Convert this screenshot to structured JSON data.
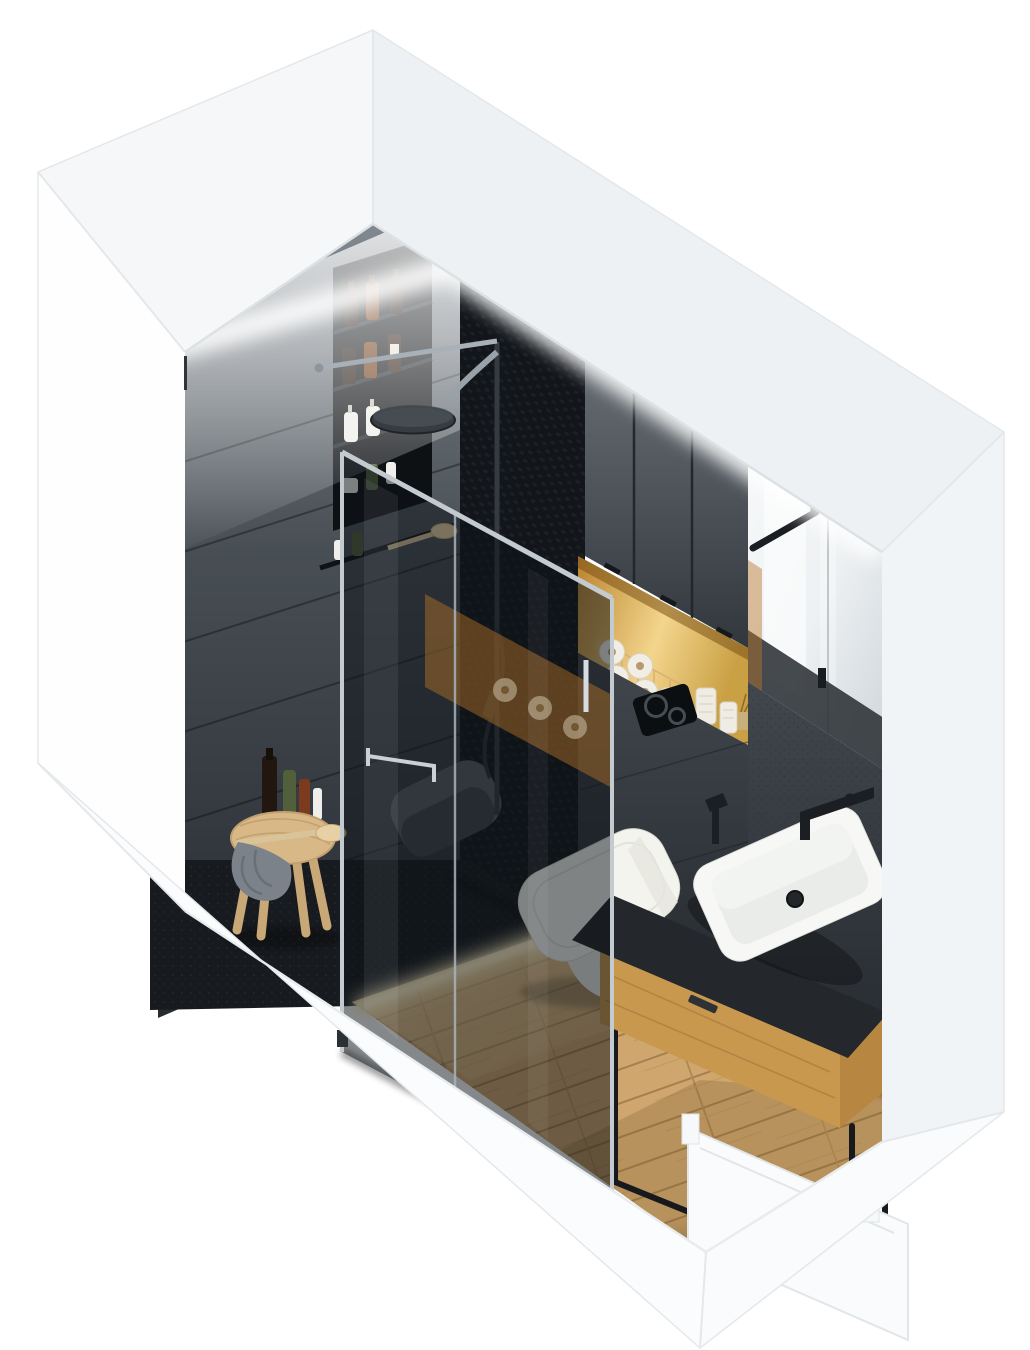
{
  "scene": {
    "kind": "isometric-bathroom-cutaway-render",
    "room": "bathroom",
    "view": "axonometric from above"
  },
  "palette": {
    "background": "#ffffff",
    "shell_white": "#fafbfc",
    "shell_top_left": "#f5f7f8",
    "shell_top_right": "#eef1f3",
    "shell_right_col": "#f1f4f6",
    "shell_left_face": "#fefeff",
    "shell_skirt": "#fbfcfd",
    "shell_edge": "#e4e8ea",
    "left_wall_top": "#8b9299",
    "left_wall_mid": "#474e54",
    "left_wall_dark": "#262b30",
    "woven_wall": "#14171b",
    "cabinet_light": "#6b7278",
    "cabinet_dark": "#31373d",
    "niche_wood": "#b9842f",
    "niche_glow": "#f3d58c",
    "mirror_light": "#eef1f3",
    "mirror_mid": "#ccd3d8",
    "mirror_reflection_dark": "#2c3135",
    "stone_mid": "#41474d",
    "stone_dark": "#24282d",
    "flush_plate_black": "#0c0f12",
    "glass_tint": "rgba(12,17,24,0.50)",
    "amber_reflection": "rgba(186,118,40,0.45)",
    "chrome": "#c3cbd1",
    "chrome_dark": "#8d969d",
    "matte_black": "#1b1e22",
    "toilet_white": "#f4f4ef",
    "toilet_shadow": "#d2d3cb",
    "basin_white": "#f7f8f5",
    "basin_inner": "#e9ece8",
    "counter_black": "#24272b",
    "vanity_wood_front": "#c9984f",
    "vanity_wood_side": "#b78742",
    "frame_black": "#17191d",
    "floor_wood_light": "#e8cd9b",
    "floor_wood_mid": "#cfa76e",
    "floor_wood_gap": "#a5804e",
    "floor_shower_dark": "#171a1e",
    "led_glow": "#fff3cf",
    "stool_wood": "#d9b888",
    "towel_gray": "#7b8289",
    "towel_gray_dark": "#686f76",
    "seat_gray": "#575d63",
    "paper_roll_white": "#f1eee6",
    "paper_roll_core": "#b59a6e",
    "candle_white": "#efece3",
    "bottle_amber": "#6e3a16",
    "bottle_dark": "#221710",
    "bottle_white": "#efeeea",
    "bottle_green": "#51603a",
    "bottle_red": "#7c3a1e",
    "brush_wood": "#e8d0a6"
  },
  "objects": {
    "walls": {
      "left_wall": "dark slate plank tiles with recessed shelf niche",
      "back_wall": "woven black shower tile, graphite cabinets, wood storage niche, stone tile, mirror"
    },
    "lighting": {
      "cove_led": "warm-white LED wash along ceiling cut",
      "floor_led": "warm LED strip at shower / wood floor boundary",
      "niche_led": "warm light inside toilet-paper niche"
    },
    "shower": {
      "glass_panels": 2,
      "rain_head": "black round rain shower head",
      "hand_shower": "black hand shower on riser",
      "bench": "gray wall-hung seat",
      "paper_holder": "chrome holder on glass"
    },
    "shelf_niche_items": [
      {
        "name": "amber-bottle",
        "color_ref": "bottle_amber"
      },
      {
        "name": "dark-bottle",
        "color_ref": "bottle_dark"
      },
      {
        "name": "white-pump-bottle",
        "color_ref": "bottle_white"
      },
      {
        "name": "white-jar",
        "color_ref": "bottle_white"
      },
      {
        "name": "green-bottle",
        "color_ref": "bottle_green"
      }
    ],
    "paper_niche_items": {
      "toilet_paper_rolls": 5,
      "candles": 2,
      "basket": "copper wire basket"
    },
    "toilet": "white wall-hung toilet with closed seat",
    "flush_plate": "black dual-flush plate with two circular buttons",
    "vanity": {
      "basin": "white rectangular vessel basin",
      "counter": "black stone top",
      "drawer": "oak drawer box",
      "frame": "black steel open frame",
      "faucet": "black wall-mounted spout",
      "sprayer": "black hand sprayer"
    },
    "mirror": "full-height mirror with black towel bar",
    "stool": {
      "material": "light wood",
      "items": [
        "gray towel",
        "dark bottle",
        "green bottle",
        "red bottle",
        "white tube",
        "wooden brush"
      ]
    },
    "floor": {
      "main": "light oak planks laid diagonally",
      "shower": "dark speckled stone tray"
    },
    "door": "white concealed door cut in lower-right wall"
  }
}
